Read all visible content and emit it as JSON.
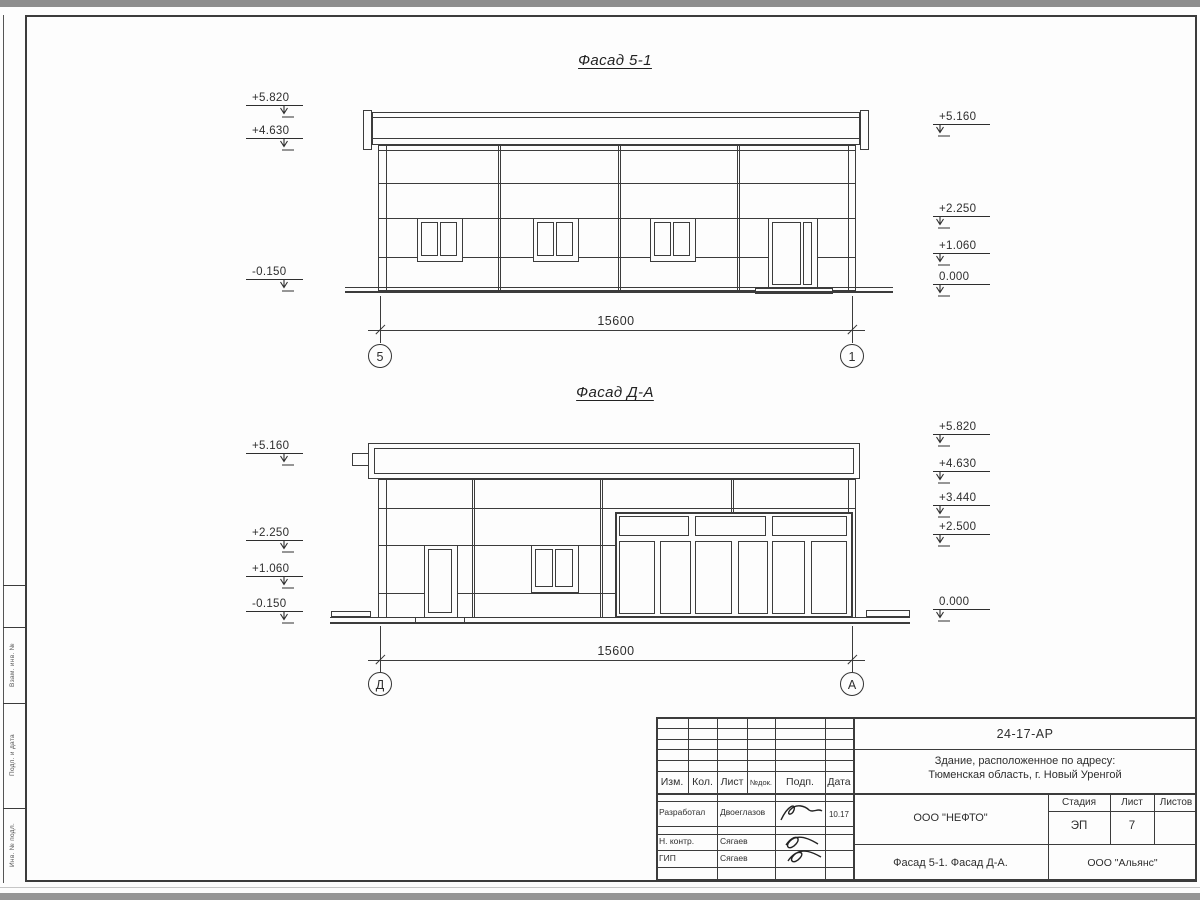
{
  "sheet": {
    "facades": [
      {
        "title": "Фасад 5-1",
        "dimension": "15600",
        "axis_left": "5",
        "axis_right": "1",
        "marks_left": [
          "+5.820",
          "+4.630",
          "-0.150"
        ],
        "marks_right": [
          "+5.160",
          "+2.250",
          "+1.060",
          "0.000"
        ]
      },
      {
        "title": "Фасад Д-А",
        "dimension": "15600",
        "axis_left": "Д",
        "axis_right": "А",
        "marks_left": [
          "+5.160",
          "+2.250",
          "+1.060",
          "-0.150"
        ],
        "marks_right": [
          "+5.820",
          "+4.630",
          "+3.440",
          "+2.500",
          "0.000"
        ]
      }
    ],
    "margin_labels": [
      "Взам. инв. №",
      "Подп. и дата",
      "Инв. № подл."
    ],
    "titleblock": {
      "doc_number": "24-17-АР",
      "project_address_line1": "Здание, расположенное по адресу:",
      "project_address_line2": "Тюменская область, г. Новый Уренгой",
      "col_headers": {
        "izm": "Изм.",
        "kol": "Кол.",
        "list": "Лист",
        "ndok": "№док.",
        "podp": "Подп.",
        "data": "Дата"
      },
      "signature_rows": [
        {
          "role": "Разработал",
          "name": "Двоеглазов",
          "date": "10.17"
        },
        {
          "role": "Н. контр.",
          "name": "Сягаев",
          "date": ""
        },
        {
          "role": "ГИП",
          "name": "Сягаев",
          "date": ""
        }
      ],
      "organization": "ООО \"НЕФТО\"",
      "stage_label": "Стадия",
      "sheet_label": "Лист",
      "sheets_label": "Листов",
      "stage_value": "ЭП",
      "sheet_value": "7",
      "sheets_value": "",
      "sheet_title": "Фасад 5-1. Фасад Д-А.",
      "contractor": "ООО \"Альянс\""
    }
  }
}
